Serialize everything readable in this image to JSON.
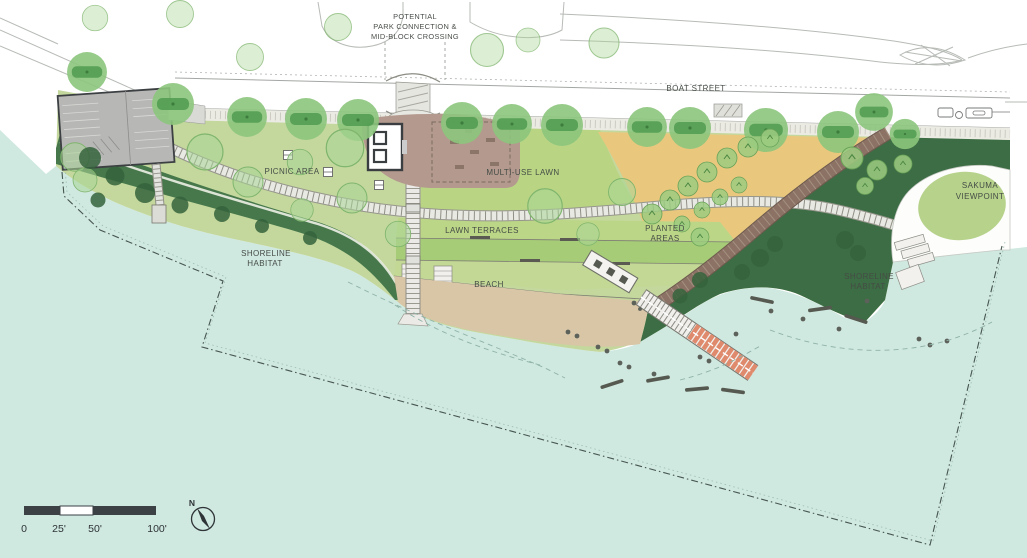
{
  "plan": {
    "labels": {
      "potential_note": [
        "POTENTIAL",
        "PARK CONNECTION &",
        "MID-BLOCK CROSSING"
      ],
      "boat_street": "BOAT STREET",
      "picnic_area": "PICNIC AREA",
      "multi_use_lawn": "MULTI-USE LAWN",
      "lawn_terraces": "LAWN TERRACES",
      "beach": "BEACH",
      "planted_areas": [
        "PLANTED",
        "AREAS"
      ],
      "shoreline_habitat_west": [
        "SHORELINE",
        "HABITAT"
      ],
      "shoreline_habitat_east": [
        "SHORELINE",
        "HABITAT"
      ],
      "sakuma_viewpoint": [
        "SAKUMA",
        "VIEWPOINT"
      ]
    },
    "scale_bar": {
      "labels": [
        "0",
        "25'",
        "50'",
        "100'"
      ]
    },
    "compass": {
      "label": "N"
    },
    "colors": {
      "water": "#cfe8e0",
      "lawn": "#c4d89d",
      "lawn_bright": "#b9d584",
      "terrace_dark": "#a6cc77",
      "terrace_light": "#c2d894",
      "shoreline_dark_green": "#47784b",
      "shoreline_deep_green": "#3d6d44",
      "planted_gold": "#e9c87e",
      "beach_sand": "#d8c6a7",
      "promenade_brown": "#8b7265",
      "path_light": "#e9e9e4",
      "pier_orange": "#e08a6d",
      "tree_light": "#8cc57c",
      "tree_band": "#4f9b50",
      "building_gray": "#b7b7b5",
      "plaza_mauve": "#b49a8e",
      "sakuma_lawn": "#b6d28b",
      "scale_bar_dark": "#3b4144",
      "ink": "#454c46"
    }
  }
}
